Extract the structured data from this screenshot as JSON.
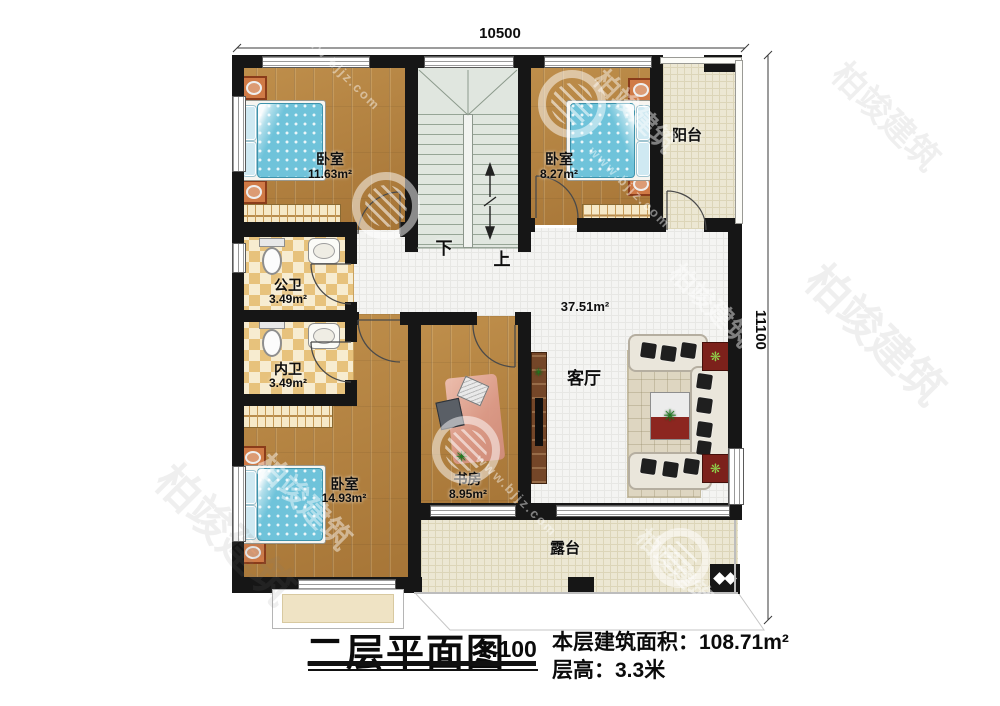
{
  "title_block": {
    "title": "二层平面图",
    "scale": "1:100",
    "area_label": "本层建筑面积：",
    "area_value": "108.71m²",
    "height_label": "层高：",
    "height_value": "3.3米"
  },
  "dimensions": {
    "width": "10500",
    "depth": "11100"
  },
  "rooms": {
    "bedroom_top_left": {
      "name": "卧室",
      "area": "11.63m²"
    },
    "bedroom_top_right": {
      "name": "卧室",
      "area": "8.27m²"
    },
    "bedroom_bottom_left": {
      "name": "卧室",
      "area": "14.93m²"
    },
    "study": {
      "name": "书房",
      "area": "8.95m²"
    },
    "living_room": {
      "name": "客厅",
      "area": "37.51m²"
    },
    "public_bathroom": {
      "name": "公卫",
      "area": "3.49m²"
    },
    "inner_bathroom": {
      "name": "内卫",
      "area": "3.49m²"
    },
    "balcony": {
      "name": "阳台"
    },
    "terrace": {
      "name": "露台"
    }
  },
  "stairs": {
    "down": "下",
    "up": "上"
  },
  "watermark": {
    "brand": "柏竣建筑",
    "url": "www.bjjz.com"
  },
  "colors": {
    "wall": "#161616",
    "wood": "#b2803e",
    "tile": "#f4f4f2",
    "balcony_tile": "#ece7d3",
    "stair": "#e0e6df",
    "bed": "#6fc3da",
    "cabinet_orange": "#cf7040",
    "table_red": "#7c211b"
  }
}
